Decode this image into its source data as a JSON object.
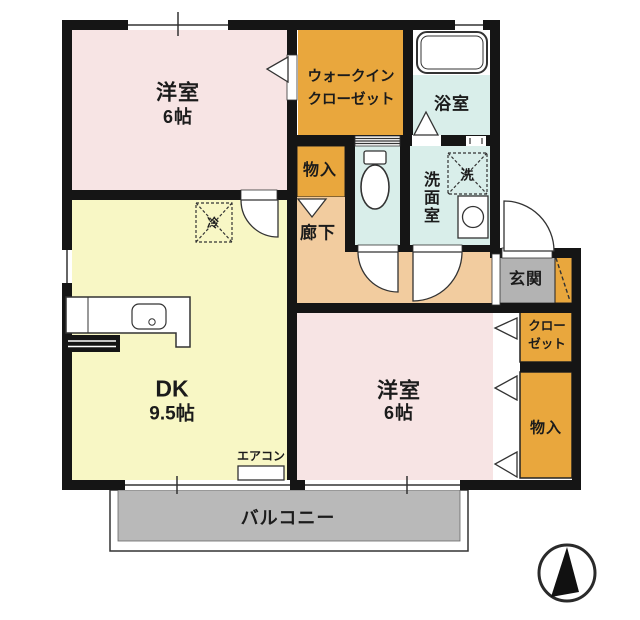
{
  "document_type": "apartment floor plan",
  "colors": {
    "wall": "#151515",
    "room_pink": "#f7e4e4",
    "dk_yellow": "#f8f7c5",
    "closet_orange": "#e9a73d",
    "corridor_peach": "#f2cc9f",
    "wet_area_blue": "#d9eeea",
    "entrance_gray": "#b3b3b3",
    "balcony_gray": "#b9b9b9",
    "line": "#333333"
  },
  "rooms": {
    "bedroom_top": {
      "name": "洋室",
      "size": "6帖"
    },
    "walk_in_closet": {
      "line1": "ウォークイン",
      "line2": "クローゼット"
    },
    "bathroom": {
      "name": "浴室"
    },
    "storage_top": {
      "name": "物入"
    },
    "washroom": {
      "name": "洗面室"
    },
    "washer": {
      "name": "洗"
    },
    "hallway": {
      "name": "廊下"
    },
    "refrigerator": {
      "name": "冷"
    },
    "entrance": {
      "name": "玄関"
    },
    "closet": {
      "line1": "クロー",
      "line2": "ゼット"
    },
    "storage_right": {
      "name": "物入"
    },
    "dining_kitchen": {
      "name": "DK",
      "size": "9.5帖"
    },
    "bedroom_bottom": {
      "name": "洋室",
      "size": "6帖"
    },
    "air_conditioner": {
      "name": "エアコン"
    },
    "balcony": {
      "name": "バルコニー"
    }
  }
}
